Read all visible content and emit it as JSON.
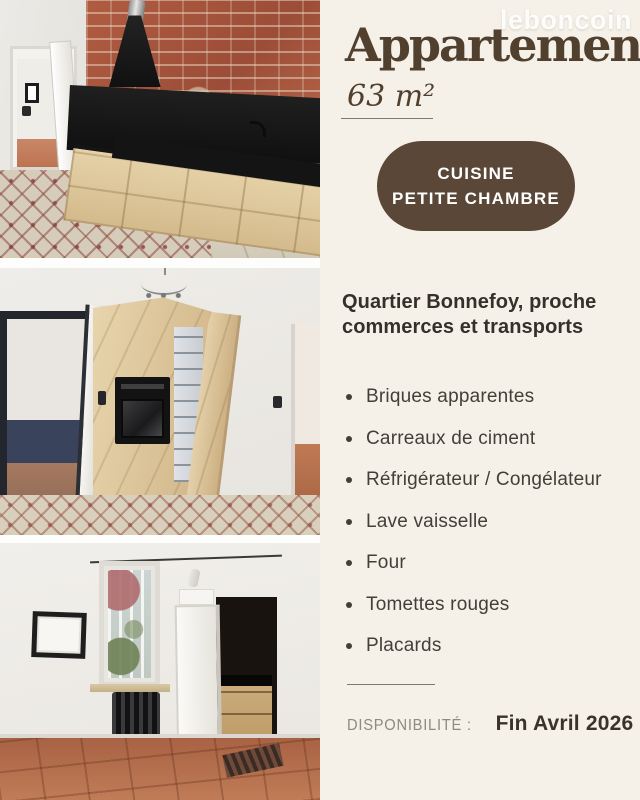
{
  "watermark": "leboncoin",
  "listing": {
    "title": "Appartement",
    "area": "63 m²",
    "badge_line1": "CUISINE",
    "badge_line2": "PETITE CHAMBRE",
    "heading": "Quartier Bonnefoy, proche commerces et transports",
    "features": [
      " Briques apparentes",
      "Carreaux de ciment",
      "Réfrigérateur / Congélateur",
      "Lave vaisselle",
      "Four",
      "Tomettes rouges",
      "Placards"
    ],
    "availability_label": "DISPONIBILITÉ :",
    "availability_value": "Fin Avril 2026"
  },
  "photos": [
    {
      "name": "kitchen-brick-wall-photo"
    },
    {
      "name": "cabinet-oven-fridge-photo"
    },
    {
      "name": "small-room-window-photo"
    }
  ],
  "colors": {
    "background": "#f5f1e8",
    "accent_brown": "#5a4737",
    "title_brown": "#52402f",
    "text_dark": "#443e39",
    "muted_gray": "#8d8a82",
    "brick": "#aa563e",
    "wood": "#d9c096",
    "terracotta": "#b4704e"
  }
}
